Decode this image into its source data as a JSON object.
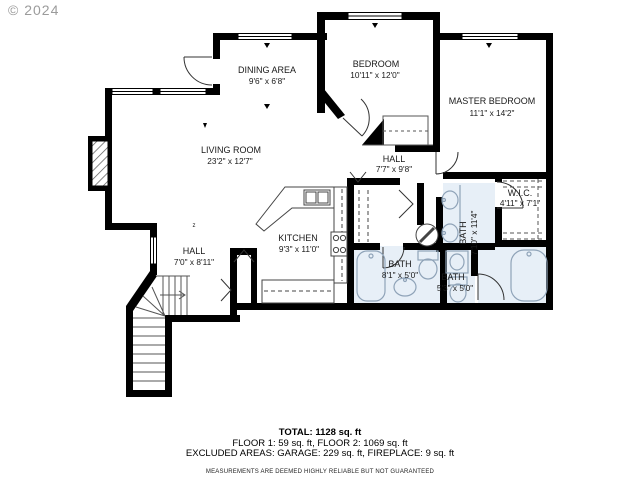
{
  "watermark": "© 2024",
  "plan": {
    "rooms": [
      {
        "id": "dining-area",
        "name": "DINING AREA",
        "dims": "9'6\" x 6'8\""
      },
      {
        "id": "bedroom",
        "name": "BEDROOM",
        "dims": "10'11\" x 12'0\""
      },
      {
        "id": "master-bedroom",
        "name": "MASTER BEDROOM",
        "dims": "11'1\" x 14'2\""
      },
      {
        "id": "living-room",
        "name": "LIVING ROOM",
        "dims": "23'2\" x 12'7\""
      },
      {
        "id": "hall-upper",
        "name": "HALL",
        "dims": "7'7\" x 9'8\""
      },
      {
        "id": "wic",
        "name": "W.I.C.",
        "dims": "4'11\" x 7'1\""
      },
      {
        "id": "kitchen",
        "name": "KITCHEN",
        "dims": "9'3\" x 11'0\""
      },
      {
        "id": "hall-lower",
        "name": "HALL",
        "dims": "7'0\" x 8'11\""
      },
      {
        "id": "bath-hall",
        "name": "BATH",
        "dims": "8'1\" x 5'0\""
      },
      {
        "id": "bath-small",
        "name": "BATH",
        "dims": "5'3\" x 5'0\""
      },
      {
        "id": "bath-master",
        "name": "BATH",
        "dims": "7'10\" x 11'4\""
      }
    ],
    "colors": {
      "wall": "#000000",
      "bath_fill": "#e7eff7",
      "fixture_stroke": "#8fa3b8",
      "watermark": "#9b9b9b"
    }
  },
  "footer": {
    "total": "TOTAL: 1128 sq. ft",
    "floors": "FLOOR 1: 59 sq. ft, FLOOR 2: 1069 sq. ft",
    "excluded": "EXCLUDED AREAS: GARAGE: 229 sq. ft, FIREPLACE: 9 sq. ft",
    "disclaimer": "MEASUREMENTS ARE DEEMED HIGHLY RELIABLE BUT NOT GUARANTEED"
  }
}
